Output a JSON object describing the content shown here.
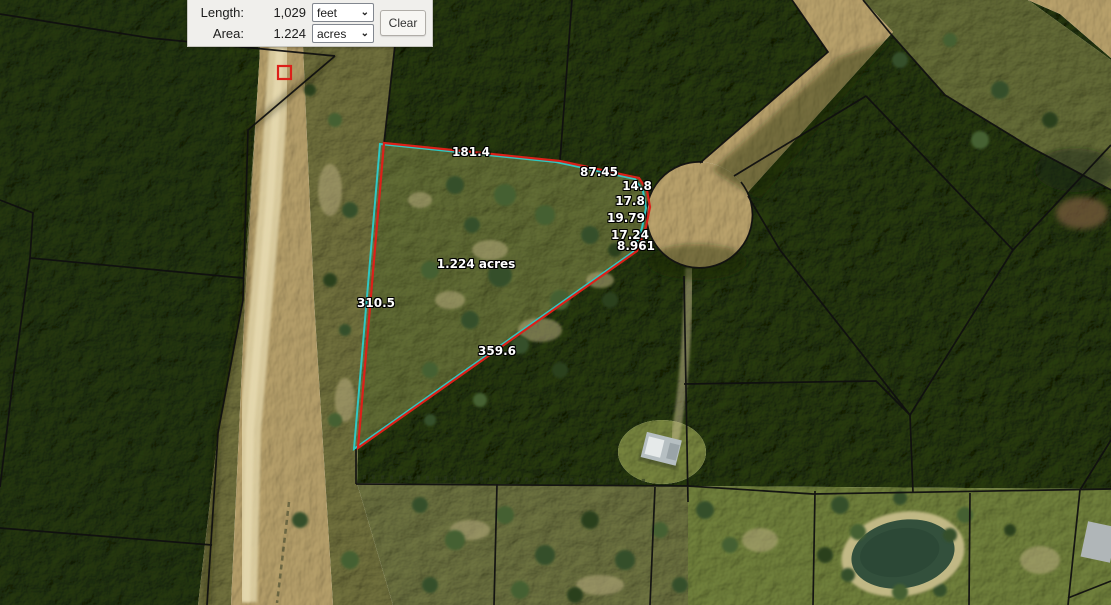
{
  "measure_panel": {
    "length_label": "Length:",
    "length_value": "1,029",
    "length_unit": "feet",
    "area_label": "Area:",
    "area_value": "1.224",
    "area_unit": "acres",
    "clear_label": "Clear",
    "chevron": "⌄"
  },
  "map": {
    "segment_labels": [
      "181.4",
      "87.45",
      "14.8",
      "17.8",
      "19.79",
      "17.24",
      "8.961",
      "310.5",
      "359.6"
    ],
    "area_text": "1.224 acres",
    "colors": {
      "measure_line": "#dc2019",
      "selection_line": "#2fc7c3",
      "parcel_line": "#101010"
    }
  }
}
